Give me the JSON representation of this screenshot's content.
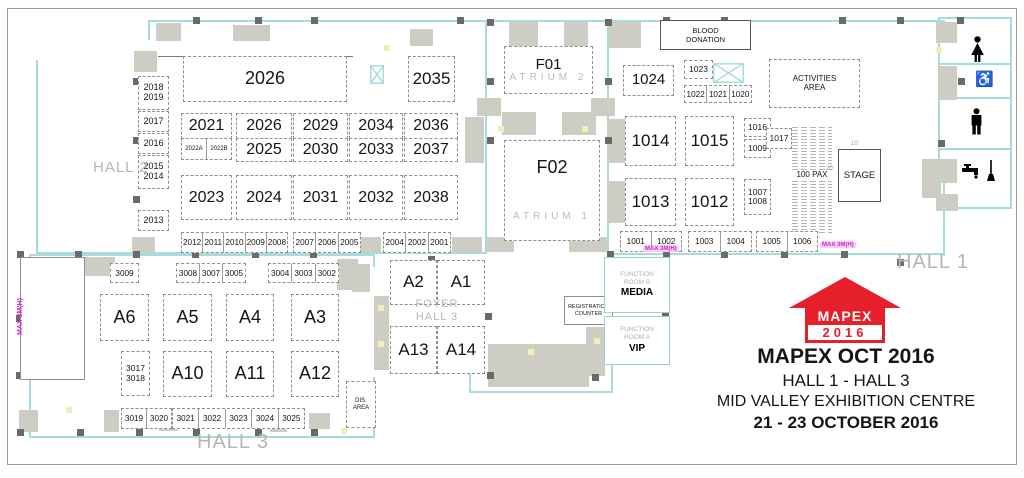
{
  "event": {
    "logo_name": "MAPEX",
    "logo_year": "2016",
    "title": "MAPEX OCT 2016",
    "subtitle": "HALL 1 - HALL 3",
    "venue": "MID VALLEY EXHIBITION CENTRE",
    "dates": "21 - 23 OCTOBER 2016"
  },
  "colors": {
    "wall": "#a8dcdc",
    "block": "#cdcdc4",
    "column": "#6a6a6a",
    "magenta": "#d726ca",
    "brand_red": "#e6202a"
  },
  "seating_label": "100 PAX",
  "icons": [
    "female-toilet-icon",
    "wheelchair-accessible-icon",
    "male-toilet-icon",
    "water-tap-icon",
    "cleaning-mop-icon"
  ],
  "booths": [
    {
      "id": "2018-2019",
      "x": 138,
      "y": 76,
      "w": 29,
      "h": 32,
      "fs": 9,
      "ls": [
        "2018",
        "2019"
      ]
    },
    {
      "id": "2017",
      "x": 138,
      "y": 111,
      "w": 29,
      "h": 19,
      "fs": 9,
      "ls": [
        "2017"
      ]
    },
    {
      "id": "2016",
      "x": 138,
      "y": 133,
      "w": 29,
      "h": 19,
      "fs": 9,
      "ls": [
        "2016"
      ]
    },
    {
      "id": "2015-2014",
      "x": 138,
      "y": 155,
      "w": 29,
      "h": 32,
      "fs": 9,
      "ls": [
        "2015",
        "2014"
      ]
    },
    {
      "id": "2013",
      "x": 138,
      "y": 210,
      "w": 29,
      "h": 19,
      "fs": 9,
      "ls": [
        "2013"
      ]
    },
    {
      "id": "2026",
      "x": 183,
      "y": 56,
      "w": 162,
      "h": 44,
      "fs": 18,
      "ls": [
        "2026"
      ]
    },
    {
      "id": "2035",
      "x": 408,
      "y": 56,
      "w": 45,
      "h": 44,
      "fs": 17,
      "ls": [
        "2035"
      ]
    },
    {
      "id": "2021",
      "x": 181,
      "y": 113,
      "w": 49,
      "h": 24,
      "fs": 16,
      "ls": [
        "2021"
      ]
    },
    {
      "id": "2026B",
      "x": 236,
      "y": 113,
      "w": 54,
      "h": 24,
      "fs": 16,
      "ls": [
        "2026"
      ]
    },
    {
      "id": "2025",
      "x": 236,
      "y": 138,
      "w": 54,
      "h": 22,
      "fs": 16,
      "ls": [
        "2025"
      ]
    },
    {
      "id": "2029",
      "x": 293,
      "y": 113,
      "w": 53,
      "h": 24,
      "fs": 16,
      "ls": [
        "2029"
      ]
    },
    {
      "id": "2030",
      "x": 293,
      "y": 138,
      "w": 53,
      "h": 22,
      "fs": 16,
      "ls": [
        "2030"
      ]
    },
    {
      "id": "2034",
      "x": 349,
      "y": 113,
      "w": 52,
      "h": 24,
      "fs": 16,
      "ls": [
        "2034"
      ]
    },
    {
      "id": "2033",
      "x": 349,
      "y": 138,
      "w": 52,
      "h": 22,
      "fs": 16,
      "ls": [
        "2033"
      ]
    },
    {
      "id": "2036",
      "x": 404,
      "y": 113,
      "w": 52,
      "h": 24,
      "fs": 16,
      "ls": [
        "2036"
      ]
    },
    {
      "id": "2037",
      "x": 404,
      "y": 138,
      "w": 52,
      "h": 22,
      "fs": 16,
      "ls": [
        "2037"
      ]
    },
    {
      "id": "2023",
      "x": 181,
      "y": 175,
      "w": 49,
      "h": 43,
      "fs": 16,
      "ls": [
        "2023"
      ]
    },
    {
      "id": "2024",
      "x": 236,
      "y": 175,
      "w": 54,
      "h": 43,
      "fs": 16,
      "ls": [
        "2024"
      ]
    },
    {
      "id": "2031",
      "x": 293,
      "y": 175,
      "w": 53,
      "h": 43,
      "fs": 16,
      "ls": [
        "2031"
      ]
    },
    {
      "id": "2032",
      "x": 349,
      "y": 175,
      "w": 52,
      "h": 43,
      "fs": 16,
      "ls": [
        "2032"
      ]
    },
    {
      "id": "2038",
      "x": 404,
      "y": 175,
      "w": 52,
      "h": 43,
      "fs": 16,
      "ls": [
        "2038"
      ]
    },
    {
      "id": "F01-atrium2",
      "x": 504,
      "y": 46,
      "w": 87,
      "h": 46,
      "ls": [
        "F01",
        "ATRIUM 2"
      ],
      "lc": [
        "f1",
        "atr"
      ]
    },
    {
      "id": "F02-atrium1",
      "x": 504,
      "y": 140,
      "w": 94,
      "h": 99,
      "cls": "spread",
      "ls": [
        "F02",
        "ATRIUM 1"
      ],
      "lc": [
        "f2",
        "atr"
      ]
    },
    {
      "id": "1024",
      "x": 623,
      "y": 65,
      "w": 49,
      "h": 29,
      "fs": 15,
      "ls": [
        "1024"
      ]
    },
    {
      "id": "1023",
      "x": 684,
      "y": 60,
      "w": 27,
      "h": 17,
      "fs": 8.5,
      "ls": [
        "1023"
      ]
    },
    {
      "id": "1014",
      "x": 625,
      "y": 116,
      "w": 49,
      "h": 48,
      "fs": 17,
      "ls": [
        "1014"
      ]
    },
    {
      "id": "1015",
      "x": 685,
      "y": 116,
      "w": 47,
      "h": 48,
      "fs": 17,
      "ls": [
        "1015"
      ]
    },
    {
      "id": "1016",
      "x": 744,
      "y": 118,
      "w": 25,
      "h": 17,
      "fs": 8.5,
      "ls": [
        "1016"
      ]
    },
    {
      "id": "1009",
      "x": 744,
      "y": 139,
      "w": 25,
      "h": 17,
      "fs": 8.5,
      "ls": [
        "1009"
      ]
    },
    {
      "id": "1017",
      "x": 766,
      "y": 128,
      "w": 24,
      "h": 19,
      "fs": 8.5,
      "ls": [
        "1017"
      ]
    },
    {
      "id": "1013",
      "x": 625,
      "y": 178,
      "w": 49,
      "h": 46,
      "fs": 17,
      "ls": [
        "1013"
      ]
    },
    {
      "id": "1012",
      "x": 685,
      "y": 178,
      "w": 47,
      "h": 46,
      "fs": 17,
      "ls": [
        "1012"
      ]
    },
    {
      "id": "1007-1008",
      "x": 744,
      "y": 179,
      "w": 25,
      "h": 34,
      "fs": 8.5,
      "ls": [
        "1007",
        "1008"
      ]
    },
    {
      "id": "activities-area",
      "x": 769,
      "y": 59,
      "w": 89,
      "h": 47,
      "fs": 8,
      "ls": [
        "ACTIVITIES",
        "AREA"
      ]
    },
    {
      "id": "A6",
      "x": 100,
      "y": 294,
      "w": 47,
      "h": 45,
      "fs": 18,
      "ls": [
        "A6"
      ]
    },
    {
      "id": "A5",
      "x": 163,
      "y": 294,
      "w": 47,
      "h": 45,
      "fs": 18,
      "ls": [
        "A5"
      ]
    },
    {
      "id": "A4",
      "x": 226,
      "y": 294,
      "w": 46,
      "h": 45,
      "fs": 18,
      "ls": [
        "A4"
      ]
    },
    {
      "id": "A3",
      "x": 291,
      "y": 294,
      "w": 46,
      "h": 45,
      "fs": 18,
      "ls": [
        "A3"
      ]
    },
    {
      "id": "3017-3018",
      "x": 121,
      "y": 351,
      "w": 27,
      "h": 43,
      "fs": 8.5,
      "ls": [
        "3017",
        "3018"
      ]
    },
    {
      "id": "A10",
      "x": 163,
      "y": 351,
      "w": 47,
      "h": 44,
      "fs": 18,
      "ls": [
        "A10"
      ]
    },
    {
      "id": "A11",
      "x": 226,
      "y": 351,
      "w": 46,
      "h": 44,
      "fs": 18,
      "ls": [
        "A11"
      ]
    },
    {
      "id": "A12",
      "x": 291,
      "y": 351,
      "w": 46,
      "h": 44,
      "fs": 18,
      "ls": [
        "A12"
      ]
    },
    {
      "id": "A2",
      "x": 390,
      "y": 260,
      "w": 45,
      "h": 43,
      "fs": 17,
      "ls": [
        "A2"
      ]
    },
    {
      "id": "A1",
      "x": 437,
      "y": 260,
      "w": 46,
      "h": 43,
      "fs": 17,
      "ls": [
        "A1"
      ]
    },
    {
      "id": "A13",
      "x": 390,
      "y": 326,
      "w": 45,
      "h": 46,
      "fs": 17,
      "ls": [
        "A13"
      ]
    },
    {
      "id": "A14",
      "x": 437,
      "y": 326,
      "w": 46,
      "h": 46,
      "fs": 17,
      "ls": [
        "A14"
      ]
    },
    {
      "id": "dis-area",
      "x": 346,
      "y": 381,
      "w": 28,
      "h": 45,
      "fs": 6,
      "ls": [
        "DIS.",
        "AREA"
      ]
    }
  ],
  "strips": [
    {
      "id": "2012-2008",
      "x": 181,
      "y": 232,
      "w": 105,
      "h": 19,
      "fs": 8.2,
      "cells": [
        "2012",
        "2011",
        "2010",
        "2009",
        "2008"
      ]
    },
    {
      "id": "2007-2005",
      "x": 293,
      "y": 232,
      "w": 66,
      "h": 19,
      "fs": 8.2,
      "cells": [
        "2007",
        "2006",
        "2005"
      ]
    },
    {
      "id": "2004-2001",
      "x": 383,
      "y": 232,
      "w": 66,
      "h": 19,
      "fs": 8.2,
      "cells": [
        "2004",
        "2002",
        "2001"
      ]
    },
    {
      "id": "2022A-2022B",
      "x": 181,
      "y": 138,
      "w": 49,
      "h": 20,
      "fs": 6,
      "cells": [
        "2022A",
        "2022B"
      ]
    },
    {
      "id": "1022-1020",
      "x": 684,
      "y": 85,
      "w": 66,
      "h": 16,
      "fs": 8.2,
      "cells": [
        "1022",
        "1021",
        "1020"
      ]
    },
    {
      "id": "1001-1002",
      "x": 620,
      "y": 231,
      "w": 60,
      "h": 19,
      "fs": 8.2,
      "cells": [
        "1001",
        "1002"
      ]
    },
    {
      "id": "1003-1004",
      "x": 688,
      "y": 231,
      "w": 62,
      "h": 19,
      "fs": 8.2,
      "cells": [
        "1003",
        "1004"
      ]
    },
    {
      "id": "1005-1006",
      "x": 756,
      "y": 231,
      "w": 60,
      "h": 19,
      "fs": 8.2,
      "cells": [
        "1005",
        "1006"
      ]
    },
    {
      "id": "3009",
      "x": 110,
      "y": 263,
      "w": 27,
      "h": 18,
      "fs": 8.2,
      "cells": [
        "3009"
      ]
    },
    {
      "id": "3008-3005",
      "x": 176,
      "y": 263,
      "w": 68,
      "h": 18,
      "fs": 8.2,
      "cells": [
        "3008",
        "3007",
        "3005"
      ]
    },
    {
      "id": "3004-3002",
      "x": 268,
      "y": 263,
      "w": 69,
      "h": 18,
      "fs": 8.2,
      "cells": [
        "3004",
        "3003",
        "3002"
      ]
    },
    {
      "id": "3019-3020",
      "x": 121,
      "y": 408,
      "w": 49,
      "h": 19,
      "fs": 8.2,
      "cells": [
        "3019",
        "3020"
      ]
    },
    {
      "id": "3021-3025",
      "x": 172,
      "y": 408,
      "w": 131,
      "h": 19,
      "fs": 8.2,
      "cells": [
        "3021",
        "3022",
        "3023",
        "3024",
        "3025"
      ]
    }
  ],
  "rooms": [
    {
      "id": "blood-donation",
      "x": 660,
      "y": 20,
      "w": 89,
      "h": 28,
      "fs": 7.5,
      "cls": "dark",
      "ls": [
        "BLOOD",
        "DONATION"
      ]
    },
    {
      "id": "stage",
      "x": 838,
      "y": 149,
      "w": 41,
      "h": 51,
      "fs": 9.5,
      "cls": "dark",
      "ls": [
        "STAGE"
      ]
    },
    {
      "id": "registration-counter",
      "x": 564,
      "y": 296,
      "w": 47,
      "h": 27,
      "fs": 5.5,
      "cls": "thin",
      "ls": [
        "REGISTRATION",
        "COUNTER"
      ]
    },
    {
      "id": "function-room-b-media",
      "x": 604,
      "y": 257,
      "w": 64,
      "h": 54,
      "cls": "cyan",
      "ls": [
        "FUNCTION",
        "ROOM B",
        "MEDIA"
      ],
      "lc": [
        "fr",
        "fr",
        "frb"
      ]
    },
    {
      "id": "function-room-a-vip",
      "x": 604,
      "y": 316,
      "w": 64,
      "h": 47,
      "cls": "cyan",
      "ls": [
        "FUNCTION",
        "ROOM A",
        "VIP"
      ],
      "lc": [
        "fr",
        "fr",
        "frb"
      ]
    },
    {
      "id": "side-room",
      "x": 20,
      "y": 257,
      "w": 63,
      "h": 121,
      "cls": "thin",
      "ls": []
    }
  ],
  "labels": [
    {
      "n": "hall2-label",
      "t": "HALL 2",
      "x": 93,
      "y": 159,
      "fs": 15,
      "cls": "hall"
    },
    {
      "n": "hall1-label",
      "t": "HALL 1",
      "x": 897,
      "y": 251,
      "fs": 20,
      "cls": "hall"
    },
    {
      "n": "hall3-label",
      "t": "HALL 3",
      "x": 197,
      "y": 431,
      "fs": 20,
      "cls": "hall"
    },
    {
      "n": "foyer-label-line1",
      "t": "FOYER",
      "x": 406,
      "y": 298,
      "fs": 11,
      "w": 62,
      "cls": "hall ctr"
    },
    {
      "n": "foyer-label-line2",
      "t": "HALL 3",
      "x": 406,
      "y": 311,
      "fs": 11,
      "w": 62,
      "cls": "hall ctr"
    },
    {
      "n": "max-height-label-vertical",
      "t": "MAX 3M(H)",
      "x": 17,
      "y": 283,
      "fs": 7,
      "h": 52,
      "cls": "maxv vert"
    },
    {
      "n": "max-height-label-1",
      "t": "MAX 3M(H)",
      "x": 643,
      "y": 246,
      "fs": 6,
      "cls": "maxh"
    },
    {
      "n": "max-height-label-2",
      "t": "MAX 3M(H)",
      "x": 820,
      "y": 242,
      "fs": 6,
      "cls": "maxh"
    },
    {
      "n": "stage-width-dim",
      "t": "10'",
      "x": 851,
      "y": 141,
      "fs": 6,
      "cls": "dim"
    },
    {
      "n": "stage-depth-dim",
      "t": "20'",
      "x": 826,
      "y": 166,
      "fs": 6,
      "cls": "dim"
    }
  ]
}
